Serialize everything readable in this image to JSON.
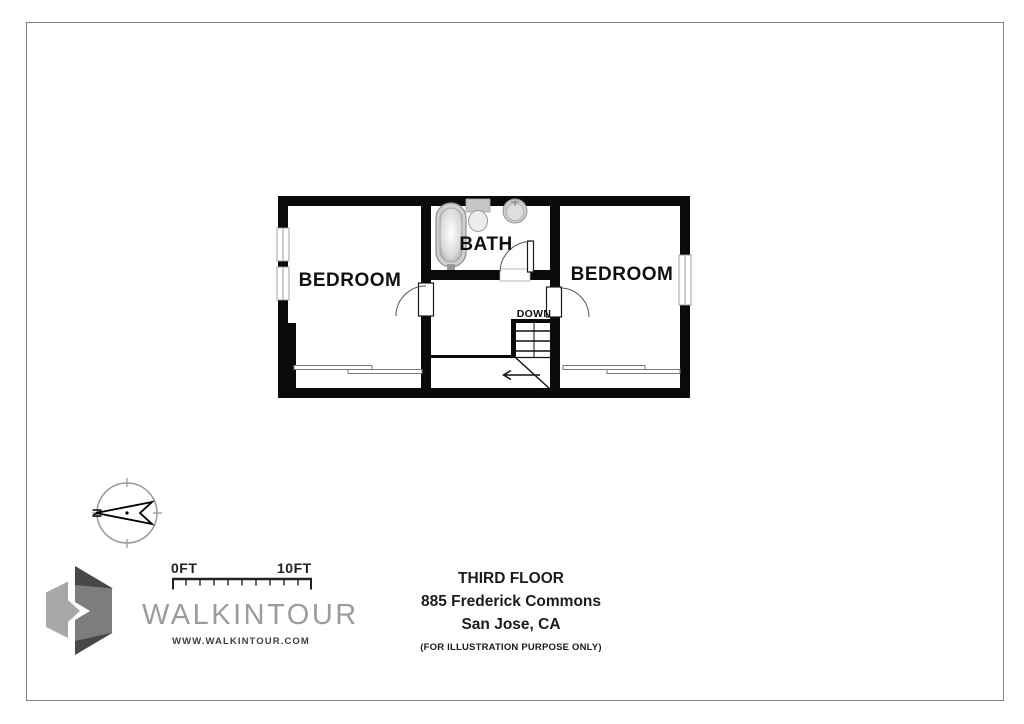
{
  "page": {
    "background_color": "#ffffff",
    "frame_border_color": "#838383"
  },
  "floor_plan": {
    "wall_color": "#0a0a0a",
    "rooms": [
      {
        "label": "BEDROOM"
      },
      {
        "label": "BATH"
      },
      {
        "label": "BEDROOM"
      }
    ],
    "stairs": {
      "direction_label": "DOWN"
    },
    "fixtures": [
      "bathtub",
      "toilet",
      "sink"
    ]
  },
  "compass": {
    "north_label": "N"
  },
  "scale_bar": {
    "start_label": "0FT",
    "end_label": "10FT"
  },
  "branding": {
    "wordmark": "WALKINTOUR",
    "website": "WWW.WALKINTOUR.COM"
  },
  "title_block": {
    "floor": "THIRD FLOOR",
    "address_line1": "885 Frederick Commons",
    "address_line2": "San Jose, CA",
    "disclaimer": "(FOR ILLUSTRATION PURPOSE ONLY)"
  }
}
